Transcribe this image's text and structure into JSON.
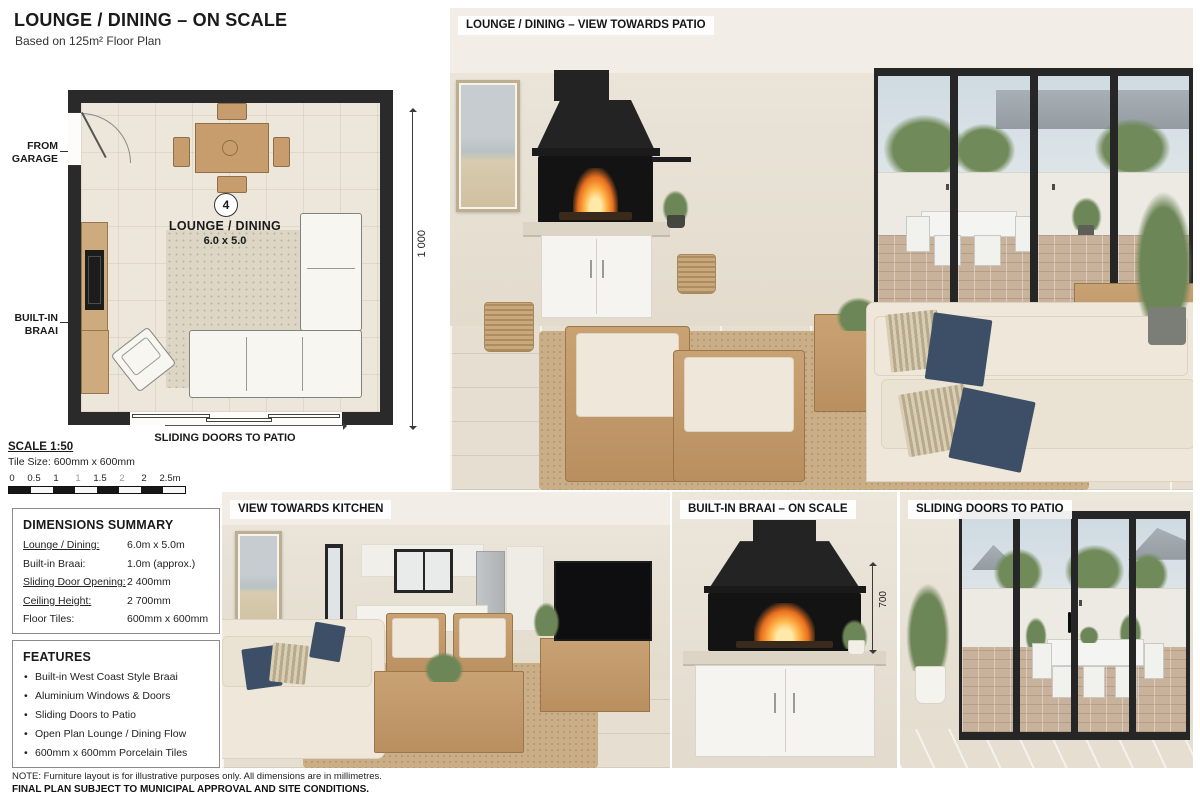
{
  "page": {
    "title": "LOUNGE / DINING – ON SCALE",
    "subtitle": "Based on 125m² Floor Plan"
  },
  "plan": {
    "dim_width": "6 000",
    "dim_height": "1 000",
    "from_garage": "FROM GARAGE",
    "built_in_braai": "BUILT-IN BRAAI",
    "room_number": "4",
    "room_name": "LOUNGE / DINING",
    "room_size": "6.0 x 5.0",
    "sliding_doors": "SLIDING DOORS TO PATIO"
  },
  "scale": {
    "title": "SCALE 1:50",
    "tile_size": "Tile Size: 600mm x 600mm",
    "bar_labels": [
      "0",
      "0.5",
      "1",
      "1",
      "1.5",
      "2",
      "2",
      "2.5m"
    ]
  },
  "dimensions_summary": {
    "title": "DIMENSIONS SUMMARY",
    "rows": [
      {
        "label": "Lounge / Dining:",
        "value": "6.0m x 5.0m"
      },
      {
        "label": "Built-in Braai:",
        "value": "1.0m (approx.)"
      },
      {
        "label": "Sliding Door Opening:",
        "value": "2 400mm"
      },
      {
        "label": "Ceiling Height:",
        "value": "2 700mm"
      },
      {
        "label": "Floor Tiles:",
        "value": "600mm x 600mm"
      }
    ]
  },
  "features": {
    "title": "FEATURES",
    "items": [
      "Built-in West Coast Style Braai",
      "Aluminium Windows & Doors",
      "Sliding Doors to Patio",
      "Open Plan Lounge / Dining Flow",
      "600mm x 600mm Porcelain Tiles"
    ]
  },
  "notes": {
    "line1": "NOTE: Furniture layout is for illustrative purposes only. All dimensions are in millimetres.",
    "line2": "FINAL PLAN SUBJECT TO MUNICIPAL APPROVAL AND SITE CONDITIONS."
  },
  "photos": {
    "main": {
      "caption": "LOUNGE / DINING – VIEW TOWARDS PATIO"
    },
    "kitchen": {
      "caption": "VIEW TOWARDS KITCHEN"
    },
    "braai": {
      "caption": "BUILT-IN BRAAI – ON SCALE",
      "dim_label": "700"
    },
    "patio": {
      "caption": "SLIDING DOORS TO PATIO"
    }
  },
  "colors": {
    "plan_wall": "#2a2a2a",
    "plan_floor": "#ede7db",
    "wood": "#c69c6d",
    "beige_wall": "#e8e2d6",
    "navy_pillow": "#3c4f66",
    "fire_orange": "#f0922f",
    "caption_bg": "#ffffff"
  }
}
